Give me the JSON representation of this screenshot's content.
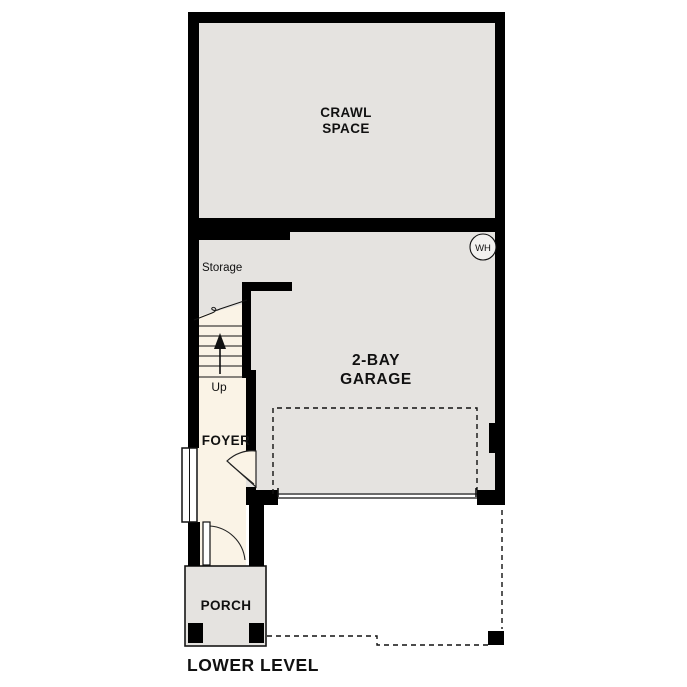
{
  "title": "LOWER LEVEL",
  "rooms": {
    "crawl_space": {
      "label_line1": "CRAWL",
      "label_line2": "SPACE"
    },
    "garage": {
      "label_line1": "2-BAY",
      "label_line2": "GARAGE"
    },
    "storage": {
      "label": "Storage"
    },
    "foyer": {
      "label": "FOYER"
    },
    "porch": {
      "label": "PORCH"
    },
    "stairs": {
      "label": "Up"
    }
  },
  "fixtures": {
    "water_heater": {
      "label": "WH"
    }
  },
  "colors": {
    "wall": "#000000",
    "room_gray": "#e5e3e0",
    "room_cream": "#faf3e6",
    "background": "#ffffff"
  }
}
